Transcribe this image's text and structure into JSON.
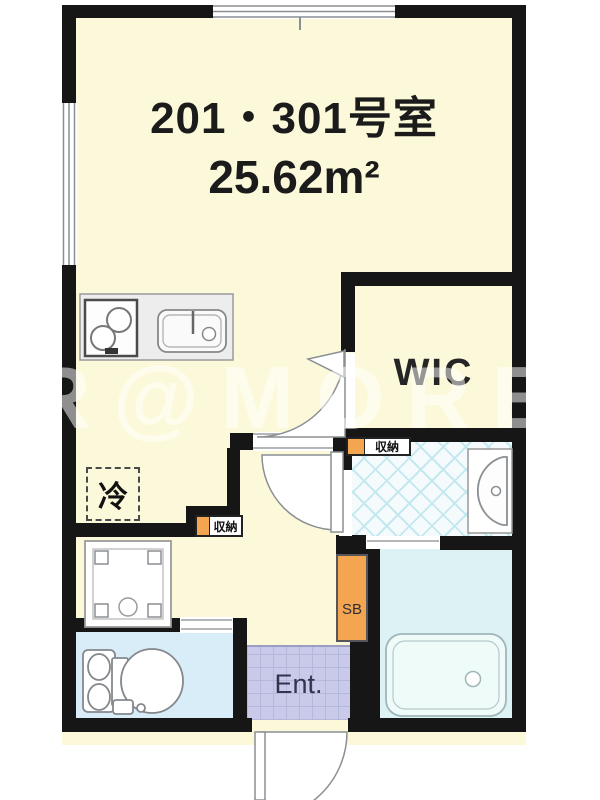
{
  "title": {
    "room_number": "201・301号室",
    "area": "25.62m²"
  },
  "labels": {
    "wic": "WIC",
    "entrance": "Ent.",
    "shoe_box": "SB",
    "storage_upper": "収納",
    "storage_lower": "収納",
    "refrigerator": "冷"
  },
  "watermark": "R@MORE",
  "colors": {
    "wall": "#161616",
    "main_floor": "#fcf9da",
    "toilet_floor": "#d9edf8",
    "bathroom_floor": "#ddf2f4",
    "bathtub_fill": "#effbf9",
    "entrance_floor": "#c9cae9",
    "washroom_lattice": "#c3e8ef",
    "storage_accent_orange": "#f3a550"
  },
  "icons": {
    "stove": "two-burner-stove-icon",
    "sink": "kitchen-sink-icon",
    "washing_machine_pan": "washing-machine-pan-icon",
    "toilet": "toilet-icon",
    "washbasin": "washbasin-icon",
    "bathtub": "bathtub-icon",
    "door": "door-swing-arc-icon",
    "window": "sliding-window-icon"
  }
}
